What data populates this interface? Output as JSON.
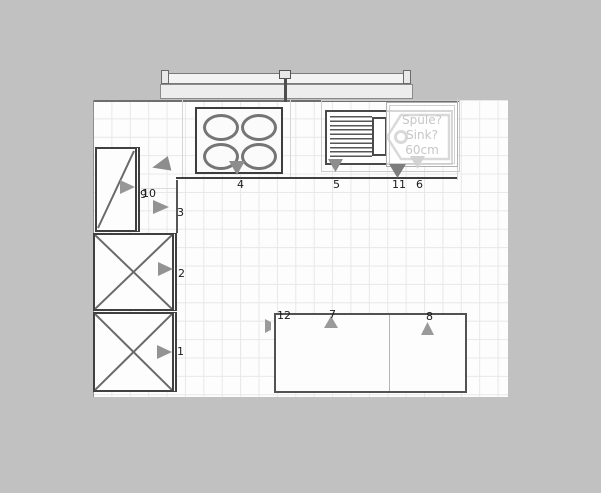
{
  "app": {
    "background_color": "#c1c1c1",
    "floor_color": "#fdfdfd",
    "grid_color": "#e8e8e8"
  },
  "sink_tooltip": {
    "line1": "Spüle?",
    "line2": "Sink?",
    "line3": "60cm",
    "text_color": "#c6c6c6"
  },
  "item_labels": [
    {
      "label": "4",
      "x": 237,
      "y": 179
    },
    {
      "label": "5",
      "x": 333,
      "y": 179
    },
    {
      "label": "11",
      "x": 392,
      "y": 179
    },
    {
      "label": "6",
      "x": 416,
      "y": 179
    },
    {
      "label": "9",
      "x": 140,
      "y": 189
    },
    {
      "label": "10",
      "x": 142,
      "y": 188
    },
    {
      "label": "3",
      "x": 177,
      "y": 207
    },
    {
      "label": "2",
      "x": 178,
      "y": 268
    },
    {
      "label": "1",
      "x": 177,
      "y": 346
    },
    {
      "label": "12",
      "x": 277,
      "y": 310
    },
    {
      "label": "7",
      "x": 329,
      "y": 309
    },
    {
      "label": "8",
      "x": 426,
      "y": 311
    }
  ],
  "direction_markers": [
    {
      "name": "marker-corner-unit",
      "dir": "left",
      "x": 152,
      "y": 158,
      "w": 18,
      "h": 15,
      "color": "#8d8d8d"
    },
    {
      "name": "marker-door-cabinet",
      "dir": "right",
      "x": 120,
      "y": 180,
      "w": 15,
      "h": 14,
      "color": "#979797"
    },
    {
      "name": "marker-item-3",
      "dir": "right",
      "x": 153,
      "y": 200,
      "w": 16,
      "h": 14,
      "color": "#939393"
    },
    {
      "name": "marker-item-2",
      "dir": "right",
      "x": 158,
      "y": 262,
      "w": 15,
      "h": 14,
      "color": "#939393"
    },
    {
      "name": "marker-item-1",
      "dir": "right",
      "x": 157,
      "y": 345,
      "w": 15,
      "h": 14,
      "color": "#939393"
    },
    {
      "name": "marker-cooktop",
      "dir": "down",
      "x": 229,
      "y": 161,
      "w": 16,
      "h": 14,
      "color": "#8d8d8d"
    },
    {
      "name": "marker-item-5",
      "dir": "down",
      "x": 328,
      "y": 159,
      "w": 15,
      "h": 13,
      "color": "#8d8d8d"
    },
    {
      "name": "marker-item-11",
      "dir": "down",
      "x": 389,
      "y": 164,
      "w": 17,
      "h": 14,
      "color": "#7d7d7d"
    },
    {
      "name": "marker-item-6",
      "dir": "down",
      "x": 410,
      "y": 156,
      "w": 15,
      "h": 13,
      "color": "#d2d2d2"
    },
    {
      "name": "marker-item-12",
      "dir": "sliver",
      "x": 265,
      "y": 319,
      "w": 6,
      "h": 14,
      "color": "#9a9a9a"
    },
    {
      "name": "marker-item-7",
      "dir": "up",
      "x": 324,
      "y": 316,
      "w": 14,
      "h": 12,
      "color": "#9a9a9a"
    },
    {
      "name": "marker-item-8",
      "dir": "up",
      "x": 421,
      "y": 322,
      "w": 13,
      "h": 13,
      "color": "#9a9a9a"
    }
  ]
}
